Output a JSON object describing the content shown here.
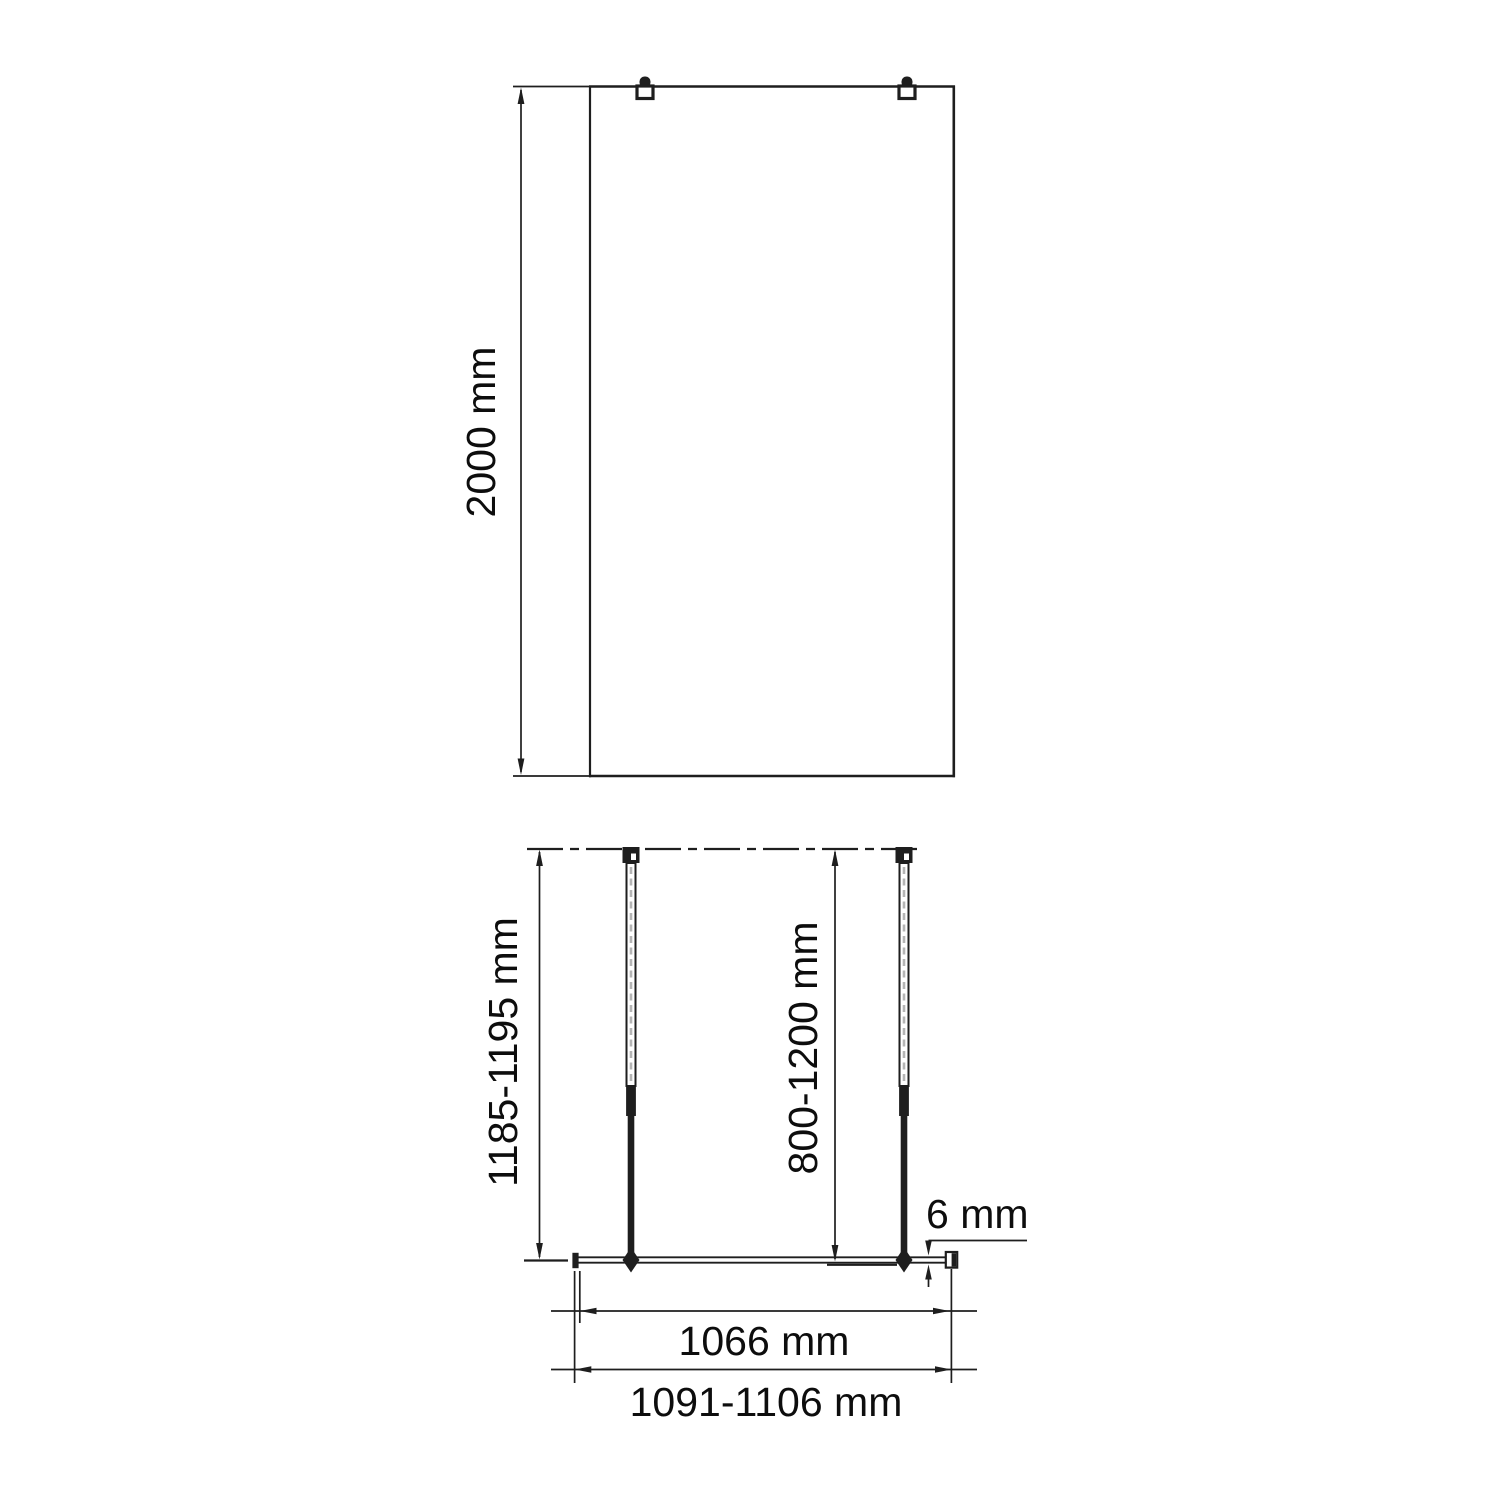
{
  "drawing": {
    "title": "shower-screen-installation-dimensions",
    "ink_color": "#1e1e1e",
    "background_color": "#ffffff",
    "front_view": {
      "height_dim": "2000 mm"
    },
    "plan_view": {
      "bar_projection_dim": "1185-1195 mm",
      "adjustment_range_dim": "800-1200 mm",
      "glass_thickness_dim": "6 mm",
      "glass_width_dim": "1066 mm",
      "overall_width_dim": "1091-1106 mm"
    }
  }
}
